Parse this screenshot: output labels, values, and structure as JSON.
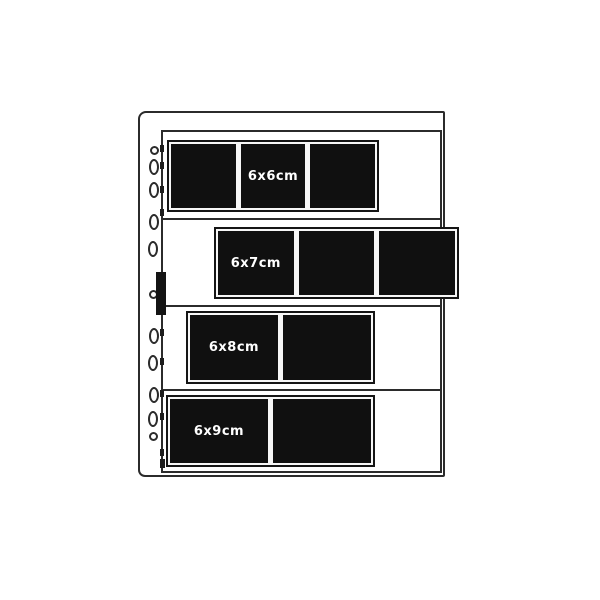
{
  "sheet": {
    "strips": [
      {
        "label": "6x6cm",
        "frames": 3,
        "label_frame_index": 1
      },
      {
        "label": "6x7cm",
        "frames": 3,
        "label_frame_index": 0
      },
      {
        "label": "6x8cm",
        "frames": 2,
        "label_frame_index": 0
      },
      {
        "label": "6x9cm",
        "frames": 2,
        "label_frame_index": 0
      }
    ],
    "punch_hole_count": 11
  },
  "icons": {
    "punch_hole": "binder-hole-icon",
    "clip_tab": "clip-tab-icon"
  },
  "colors": {
    "ink": "#2b2b2b",
    "film_black": "#101010",
    "paper": "#ffffff",
    "label_text": "#ffffff"
  }
}
